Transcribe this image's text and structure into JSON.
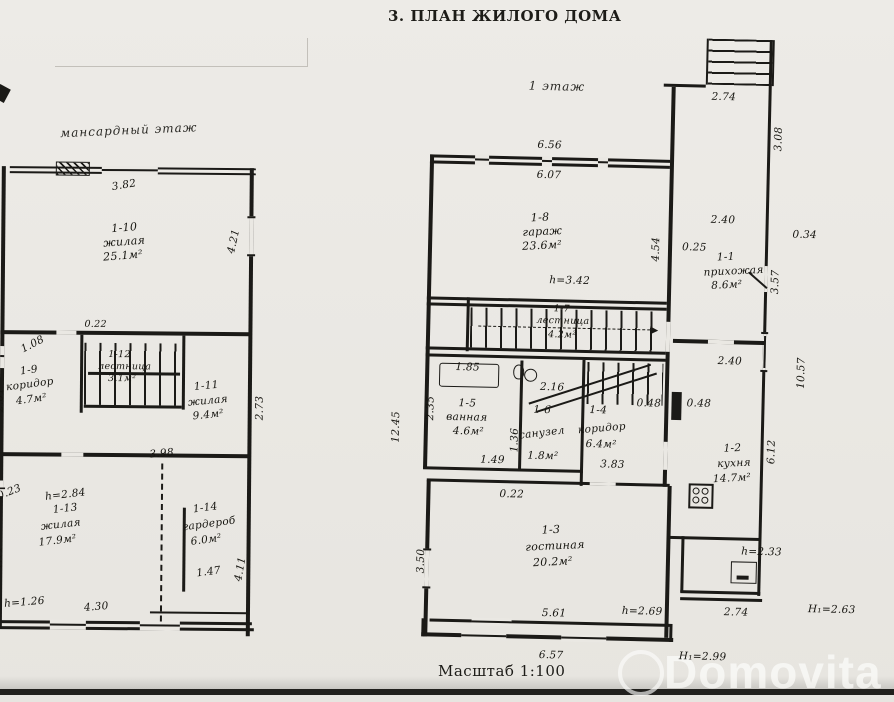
{
  "title": "3. ПЛАН ЖИЛОГО ДОМА",
  "scale_note": "Масштаб 1:100",
  "watermark": "Domovita",
  "ink_color": "#1b1a17",
  "paper_color": "#eae8e3",
  "attic": {
    "floor_label": "мансардный этаж",
    "rooms": {
      "r10": {
        "id": "1-10",
        "name": "жилая",
        "area": "25.1м²"
      },
      "r9": {
        "id": "1-9",
        "name": "коридор",
        "area": "4.7м²"
      },
      "r12": {
        "id": "1-12",
        "name": "лестница",
        "area": "3.1м²"
      },
      "r11": {
        "id": "1-11",
        "name": "жилая",
        "area": "9.4м²"
      },
      "r13": {
        "id": "1-13",
        "name": "жилая",
        "area": "17.9м²",
        "height_note": "h=2.84"
      },
      "r14": {
        "id": "1-14",
        "name": "гардероб",
        "area": "6.0м²"
      }
    },
    "dims": {
      "top": "3.82",
      "right_upper": "4.21",
      "stairs_top": "0.22",
      "left_diag": "1.08",
      "left_mid": "2.01",
      "right_mid": "2.73",
      "mid_bottom": "3.98",
      "left_notch": "0.23",
      "left_lower": "4.11",
      "right_lower": "4.11",
      "wardrobe_inner": "1.47",
      "bottom_height": "h=1.26",
      "bottom_width": "4.30"
    }
  },
  "floor1": {
    "floor_label": "1 этаж",
    "rooms": {
      "r8": {
        "id": "1-8",
        "name": "гараж",
        "area": "23.6м²",
        "height_note": "h=3.42"
      },
      "r7": {
        "id": "1-7",
        "name": "лестница",
        "area": "4.2м²"
      },
      "r1": {
        "id": "1-1",
        "name": "прихожая",
        "area": "8.6м²"
      },
      "r2": {
        "id": "1-2",
        "name": "кухня",
        "area": "14.7м²"
      },
      "r5": {
        "id": "1-5",
        "name": "ванная",
        "area": "4.6м²"
      },
      "r6": {
        "id": "1-6",
        "name": "санузел",
        "area": "1.8м²"
      },
      "r4": {
        "id": "1-4",
        "name": "коридор",
        "area": "6.4м²"
      },
      "r3": {
        "id": "1-3",
        "name": "гостиная",
        "area": "20.2м²"
      }
    },
    "dims": {
      "porch_top_w": "2.74",
      "porch_right_h": "3.08",
      "garage_top_out": "6.56",
      "garage_top_in": "6.07",
      "garage_right_h": "4.54",
      "hall_top": "2.40",
      "hall_left": "0.25",
      "hall_right_out": "0.34",
      "hall_right_h": "3.57",
      "kitchen_top": "2.40",
      "kitchen_left": "0.48",
      "kitchen_right_out": "10.57",
      "kitchen_right_in": "6.12",
      "left_out_h": "12.45",
      "bath_top": "1.85",
      "bath_left_h": "2.35",
      "bath_bottom": "1.49",
      "bath_right_h": "1.36",
      "wc_h": "2.16",
      "corridor_bottom": "3.83",
      "corridor_right": "0.48",
      "living_top": "0.22",
      "living_left_h": "3.50",
      "living_bottom": "5.61",
      "living_height": "h=2.69",
      "bottom_w": "6.57",
      "bottom_height": "Н₁=2.99",
      "boiler_height": "h=2.33",
      "porch2_w": "2.74",
      "porch2_height": "Н₁=2.63"
    }
  }
}
